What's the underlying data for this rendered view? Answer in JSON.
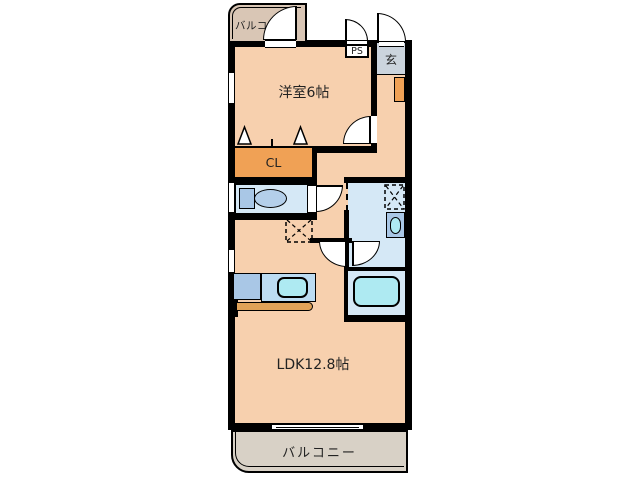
{
  "plan": {
    "balcony_top": "バルコニー",
    "western_room": "洋室6帖",
    "pipe_space": "PS",
    "entrance": "玄",
    "closet": "CL",
    "ldk": "LDK12.8帖",
    "balcony_bottom": "バルコニー"
  },
  "colors": {
    "wall": "#000000",
    "room_floor": "#f7d0ae",
    "balcony_top": "#d9c6b5",
    "balcony_bottom": "#d8d1c6",
    "closet_orange": "#f0a155",
    "entrance_gray": "#cbd4dd",
    "wet_area_blue": "#d5e8f6",
    "fixture_blue": "#a9c7e6",
    "fixture_blue_light": "#bcdcf2",
    "basin_cyan": "#aeeaf2",
    "counter_tan": "#e0a258",
    "text": "#222222"
  },
  "fixtures": [
    "toilet-icon",
    "kitchen-sink-icon",
    "kitchen-counter-icon",
    "refrigerator-space-icon",
    "washing-machine-space-icon",
    "vanity-sink-icon",
    "bathtub-icon",
    "shoe-cabinet-icon",
    "folding-closet-door-icon",
    "door-swing-icon",
    "window-icon",
    "sliding-window-icon"
  ]
}
